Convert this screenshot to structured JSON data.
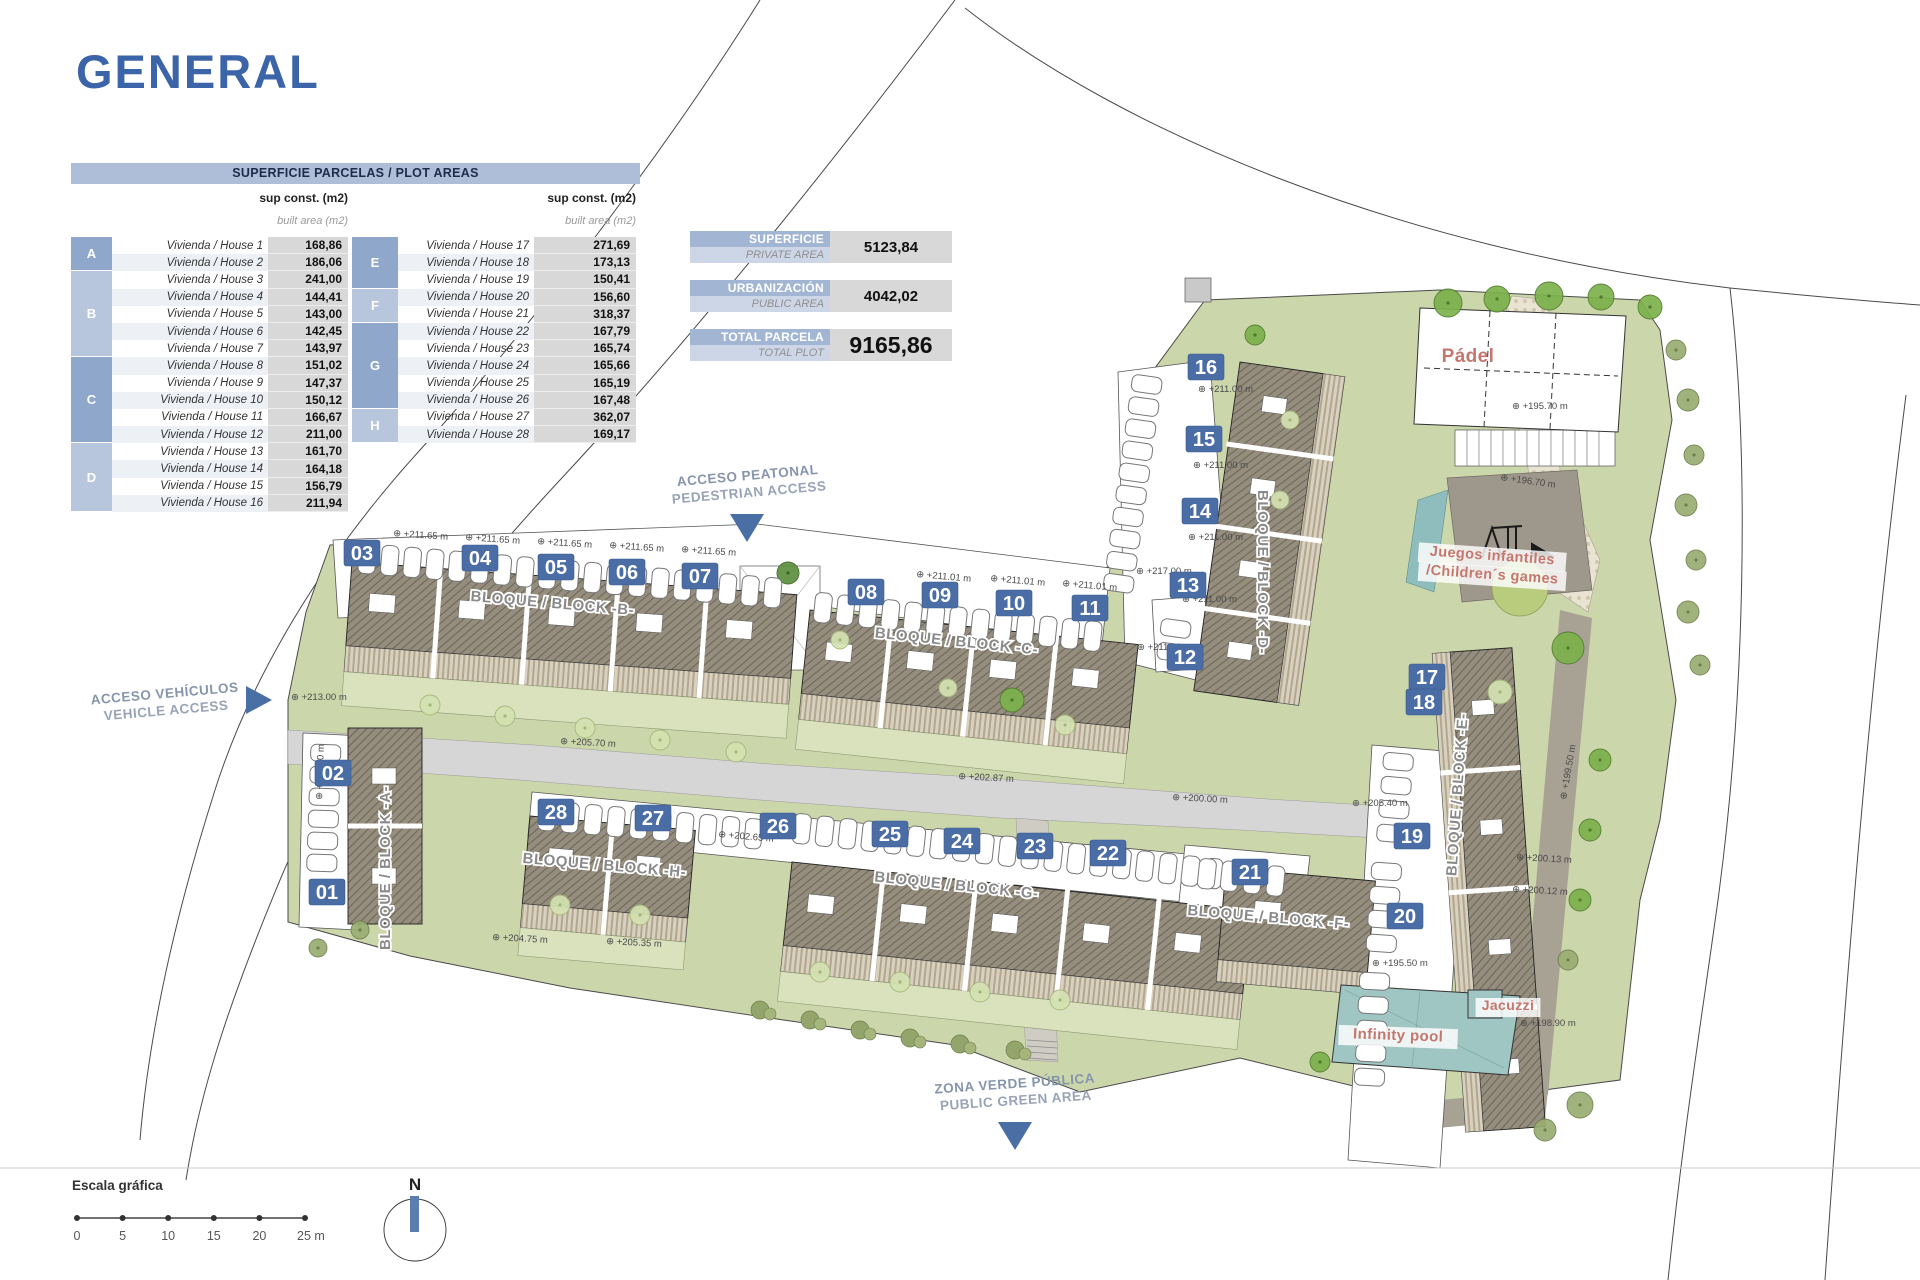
{
  "title": "GENERAL",
  "plot_table": {
    "header": "SUPERFICIE PARCELAS / PLOT AREAS",
    "col_header": "sup const. (m2)",
    "col_subheader": "built area (m2)",
    "house_prefix": "Vivienda / House",
    "left_groups": [
      {
        "letter": "A",
        "shade": "dark",
        "rows": [
          {
            "n": 1,
            "v": "168,86"
          },
          {
            "n": 2,
            "v": "186,06"
          }
        ]
      },
      {
        "letter": "B",
        "shade": "light",
        "rows": [
          {
            "n": 3,
            "v": "241,00"
          },
          {
            "n": 4,
            "v": "144,41"
          },
          {
            "n": 5,
            "v": "143,00"
          },
          {
            "n": 6,
            "v": "142,45"
          },
          {
            "n": 7,
            "v": "143,97"
          }
        ]
      },
      {
        "letter": "C",
        "shade": "dark",
        "rows": [
          {
            "n": 8,
            "v": "151,02"
          },
          {
            "n": 9,
            "v": "147,37"
          },
          {
            "n": 10,
            "v": "150,12"
          },
          {
            "n": 11,
            "v": "166,67"
          },
          {
            "n": 12,
            "v": "211,00"
          }
        ]
      },
      {
        "letter": "D",
        "shade": "light",
        "rows": [
          {
            "n": 13,
            "v": "161,70"
          },
          {
            "n": 14,
            "v": "164,18"
          },
          {
            "n": 15,
            "v": "156,79"
          },
          {
            "n": 16,
            "v": "211,94"
          }
        ]
      }
    ],
    "right_groups": [
      {
        "letter": "E",
        "shade": "dark",
        "rows": [
          {
            "n": 17,
            "v": "271,69"
          },
          {
            "n": 18,
            "v": "173,13"
          },
          {
            "n": 19,
            "v": "150,41"
          }
        ]
      },
      {
        "letter": "F",
        "shade": "light",
        "rows": [
          {
            "n": 20,
            "v": "156,60"
          },
          {
            "n": 21,
            "v": "318,37"
          }
        ]
      },
      {
        "letter": "G",
        "shade": "dark",
        "rows": [
          {
            "n": 22,
            "v": "167,79"
          },
          {
            "n": 23,
            "v": "165,74"
          },
          {
            "n": 24,
            "v": "165,66"
          },
          {
            "n": 25,
            "v": "165,19"
          },
          {
            "n": 26,
            "v": "167,48"
          }
        ]
      },
      {
        "letter": "H",
        "shade": "light",
        "rows": [
          {
            "n": 27,
            "v": "362,07"
          },
          {
            "n": 28,
            "v": "169,17"
          }
        ]
      }
    ]
  },
  "summary_boxes": [
    {
      "label_es": "SUPERFICIE",
      "label_en": "PRIVATE AREA",
      "value": "5123,84",
      "big": false
    },
    {
      "label_es": "URBANIZACIÓN",
      "label_en": "PUBLIC AREA",
      "value": "4042,02",
      "big": false
    },
    {
      "label_es": "TOTAL PARCELA",
      "label_en": "TOTAL PLOT",
      "value": "9165,86",
      "big": true
    }
  ],
  "plan": {
    "unit_badges": [
      {
        "n": "01",
        "x": 327,
        "y": 892
      },
      {
        "n": "02",
        "x": 333,
        "y": 773
      },
      {
        "n": "03",
        "x": 362,
        "y": 553
      },
      {
        "n": "04",
        "x": 480,
        "y": 558
      },
      {
        "n": "05",
        "x": 556,
        "y": 567
      },
      {
        "n": "06",
        "x": 627,
        "y": 572
      },
      {
        "n": "07",
        "x": 700,
        "y": 576
      },
      {
        "n": "08",
        "x": 866,
        "y": 592
      },
      {
        "n": "09",
        "x": 940,
        "y": 595
      },
      {
        "n": "10",
        "x": 1014,
        "y": 603
      },
      {
        "n": "11",
        "x": 1090,
        "y": 608
      },
      {
        "n": "12",
        "x": 1185,
        "y": 657
      },
      {
        "n": "13",
        "x": 1188,
        "y": 585
      },
      {
        "n": "14",
        "x": 1200,
        "y": 511
      },
      {
        "n": "15",
        "x": 1204,
        "y": 439
      },
      {
        "n": "16",
        "x": 1206,
        "y": 367
      },
      {
        "n": "17",
        "x": 1427,
        "y": 677
      },
      {
        "n": "18",
        "x": 1424,
        "y": 702
      },
      {
        "n": "19",
        "x": 1412,
        "y": 836
      },
      {
        "n": "20",
        "x": 1405,
        "y": 916
      },
      {
        "n": "21",
        "x": 1250,
        "y": 872
      },
      {
        "n": "22",
        "x": 1108,
        "y": 853
      },
      {
        "n": "23",
        "x": 1035,
        "y": 846
      },
      {
        "n": "24",
        "x": 962,
        "y": 841
      },
      {
        "n": "25",
        "x": 890,
        "y": 834
      },
      {
        "n": "26",
        "x": 778,
        "y": 826
      },
      {
        "n": "27",
        "x": 653,
        "y": 818
      },
      {
        "n": "28",
        "x": 556,
        "y": 812
      }
    ],
    "block_labels": [
      {
        "text": "BLOQUE / BLOCK -A-",
        "x": 390,
        "y": 868,
        "rot": -90
      },
      {
        "text": "BLOQUE / BLOCK -B-",
        "x": 552,
        "y": 608,
        "rot": 5
      },
      {
        "text": "BLOQUE / BLOCK -C-",
        "x": 956,
        "y": 646,
        "rot": 6
      },
      {
        "text": "BLOQUE / BLOCK -D-",
        "x": 1258,
        "y": 572,
        "rot": 90
      },
      {
        "text": "BLOQUE / BLOCK -E-",
        "x": 1462,
        "y": 795,
        "rot": -86
      },
      {
        "text": "BLOQUE / BLOCK -F-",
        "x": 1268,
        "y": 922,
        "rot": 5
      },
      {
        "text": "BLOQUE / BLOCK -G-",
        "x": 956,
        "y": 890,
        "rot": 6
      },
      {
        "text": "BLOQUE / BLOCK -H-",
        "x": 604,
        "y": 870,
        "rot": 5
      }
    ],
    "access_labels": [
      {
        "line1": "ACCESO PEATONAL",
        "line2": "PEDESTRIAN ACCESS",
        "x": 748,
        "y": 480,
        "rot": -5,
        "arrow": "down",
        "ax": 747,
        "ay": 514
      },
      {
        "line1": "ACCESO VEHÍCULOS",
        "line2": "VEHICLE ACCESS",
        "x": 165,
        "y": 698,
        "rot": -5,
        "arrow": "right",
        "ax": 246,
        "ay": 700
      },
      {
        "line1": "ZONA VERDE PÚBLICA",
        "line2": "PUBLIC GREEN AREA",
        "x": 1015,
        "y": 1088,
        "rot": -4,
        "arrow": "down",
        "ax": 1015,
        "ay": 1122
      }
    ],
    "amenities": [
      {
        "text": "Pádel",
        "x": 1468,
        "y": 362,
        "size": 19,
        "chip": false,
        "rot": 0
      },
      {
        "text": "Juegos infantiles",
        "x": 1492,
        "y": 560,
        "size": 14.5,
        "chip": true,
        "rot": 4
      },
      {
        "text": "/Children´s games",
        "x": 1492,
        "y": 579,
        "size": 14.5,
        "chip": true,
        "rot": 4
      },
      {
        "text": "Jacuzzi",
        "x": 1508,
        "y": 1010,
        "size": 14,
        "chip": true,
        "rot": 0
      },
      {
        "text": "Infinity pool",
        "x": 1398,
        "y": 1040,
        "size": 15,
        "chip": true,
        "rot": 2
      }
    ],
    "elevations": [
      {
        "t": "+211.65 m",
        "x": 393,
        "y": 536,
        "r": 4
      },
      {
        "t": "+211.65 m",
        "x": 465,
        "y": 540,
        "r": 4
      },
      {
        "t": "+211.65 m",
        "x": 537,
        "y": 544,
        "r": 4
      },
      {
        "t": "+211.65 m",
        "x": 609,
        "y": 548,
        "r": 4
      },
      {
        "t": "+211.65 m",
        "x": 681,
        "y": 552,
        "r": 4
      },
      {
        "t": "+211.01 m",
        "x": 916,
        "y": 577,
        "r": 5
      },
      {
        "t": "+211.01 m",
        "x": 990,
        "y": 581,
        "r": 5
      },
      {
        "t": "+211.01 m",
        "x": 1062,
        "y": 586,
        "r": 5
      },
      {
        "t": "+217.00 m",
        "x": 1136,
        "y": 574,
        "r": 0
      },
      {
        "t": "+211.00 m",
        "x": 1182,
        "y": 602,
        "r": 0
      },
      {
        "t": "+211.00 m",
        "x": 1137,
        "y": 650,
        "r": 0
      },
      {
        "t": "+211.00 m",
        "x": 1198,
        "y": 392,
        "r": 0
      },
      {
        "t": "+211.00 m",
        "x": 1193,
        "y": 468,
        "r": 0
      },
      {
        "t": "+211.00 m",
        "x": 1188,
        "y": 540,
        "r": 0
      },
      {
        "t": "+213.00 m",
        "x": 291,
        "y": 700,
        "r": 0
      },
      {
        "t": "+213.00 m",
        "x": 322,
        "y": 800,
        "r": -88
      },
      {
        "t": "+205.70 m",
        "x": 560,
        "y": 744,
        "r": 3
      },
      {
        "t": "+202.87 m",
        "x": 958,
        "y": 779,
        "r": 3
      },
      {
        "t": "+200.00 m",
        "x": 1172,
        "y": 800,
        "r": 3
      },
      {
        "t": "+205.40 m",
        "x": 1352,
        "y": 806,
        "r": 0
      },
      {
        "t": "+202.65 m",
        "x": 718,
        "y": 837,
        "r": 5
      },
      {
        "t": "+204.75 m",
        "x": 492,
        "y": 940,
        "r": 3
      },
      {
        "t": "+205.35 m",
        "x": 606,
        "y": 944,
        "r": 3
      },
      {
        "t": "+195.50 m",
        "x": 1372,
        "y": 966,
        "r": 0
      },
      {
        "t": "+200.13 m",
        "x": 1516,
        "y": 860,
        "r": 3
      },
      {
        "t": "+200.12 m",
        "x": 1512,
        "y": 892,
        "r": 3
      },
      {
        "t": "+199.50 m",
        "x": 1566,
        "y": 800,
        "r": -80
      },
      {
        "t": "+195.70 m",
        "x": 1512,
        "y": 409,
        "r": 0
      },
      {
        "t": "+196.70 m",
        "x": 1500,
        "y": 480,
        "r": 8
      },
      {
        "t": "+198.90 m",
        "x": 1520,
        "y": 1026,
        "r": 0
      }
    ],
    "north_label": "N",
    "scale": {
      "title": "Escala gráfica",
      "ticks": [
        "0",
        "5",
        "10",
        "15",
        "20",
        "25 m"
      ]
    }
  },
  "colors": {
    "accent_blue": "#3c64a8",
    "badge_blue": "#4b6da6",
    "grass": "#ccd6ab",
    "pool": "#9fc6c3",
    "label_red": "#c4776e",
    "road_gray": "#d6d6d6",
    "access_blue": "#4a6fa5",
    "access_text": "#8695ac",
    "table_header_bg": "#aebed8",
    "letter_dark": "#8ea7ca",
    "letter_light": "#b7c6dd",
    "value_bg": "#d8d8d8"
  }
}
